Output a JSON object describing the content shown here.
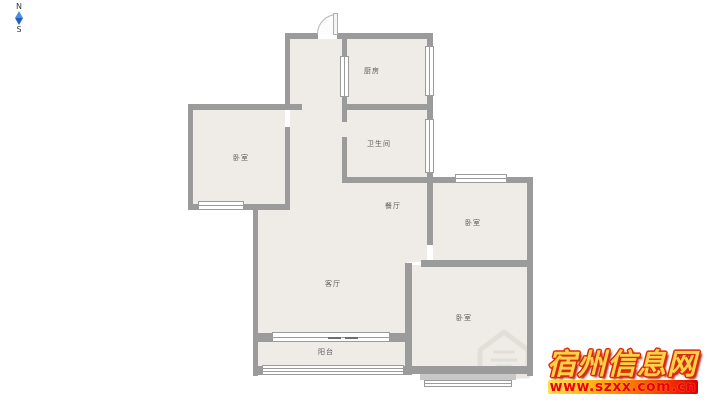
{
  "compass": {
    "north_label": "N",
    "south_label": "S"
  },
  "floor_plan": {
    "rooms": {
      "kitchen": "厨房",
      "bathroom": "卫生间",
      "bedroom_left": "卧室",
      "dining_room": "餐厅",
      "bedroom_right": "卧室",
      "living_room": "客厅",
      "bedroom_bottom": "卧室",
      "balcony": "阳台"
    }
  },
  "watermark": {
    "site_name": "宿州信息网",
    "site_url": "www.szxx.com.cn"
  },
  "colors": {
    "wall": "#9b9b9b",
    "floor": "#efece7",
    "bay_sill": "#c8c8c8",
    "watermark_gold": "#ffd24a",
    "watermark_red_outline": "#dd2800",
    "url_text_red": "#ee0000",
    "compass_blue_top": "#4a90e2",
    "compass_blue_bottom": "#1f5fc4"
  }
}
